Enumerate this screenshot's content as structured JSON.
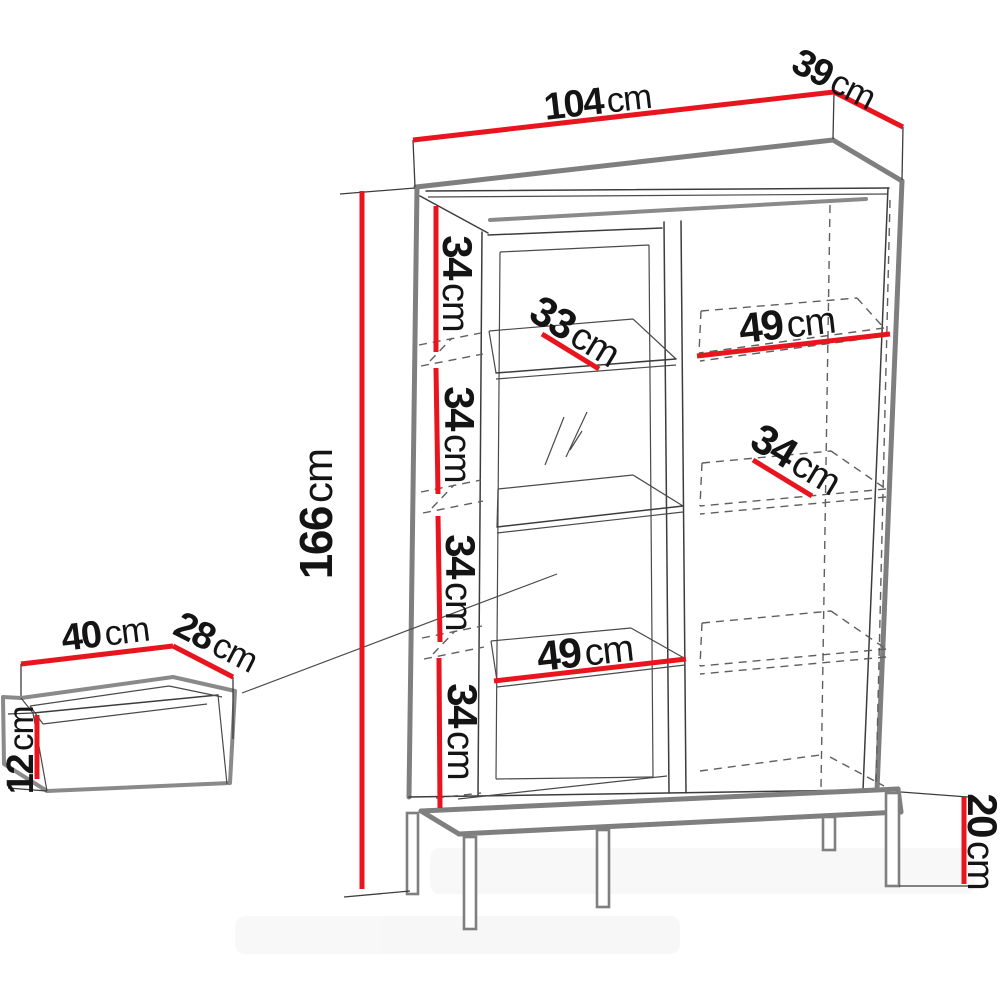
{
  "palette": {
    "dimension_red": "#e8151e",
    "outline_gray": "#7f7f7f",
    "line_dark": "#3c3c3c",
    "background": "#ffffff"
  },
  "cabinet": {
    "description": "display cabinet with glass door, side shelves and metal base",
    "dims": {
      "width": {
        "value": "104",
        "unit": "cm"
      },
      "depth": {
        "value": "39",
        "unit": "cm"
      },
      "height": {
        "value": "166",
        "unit": "cm"
      },
      "section_heights": [
        {
          "value": "34",
          "unit": "cm"
        },
        {
          "value": "34",
          "unit": "cm"
        },
        {
          "value": "34",
          "unit": "cm"
        },
        {
          "value": "34",
          "unit": "cm"
        }
      ],
      "glass_shelf_depth": {
        "value": "33",
        "unit": "cm"
      },
      "right_shelf_width": {
        "value": "49",
        "unit": "cm"
      },
      "right_shelf_depth": {
        "value": "34",
        "unit": "cm"
      },
      "left_shelf_width": {
        "value": "49",
        "unit": "cm"
      },
      "base_height": {
        "value": "20",
        "unit": "cm"
      }
    }
  },
  "drawer": {
    "description": "internal drawer box",
    "dims": {
      "width": {
        "value": "40",
        "unit": "cm"
      },
      "depth": {
        "value": "28",
        "unit": "cm"
      },
      "height": {
        "value": "12",
        "unit": "cm"
      }
    }
  }
}
